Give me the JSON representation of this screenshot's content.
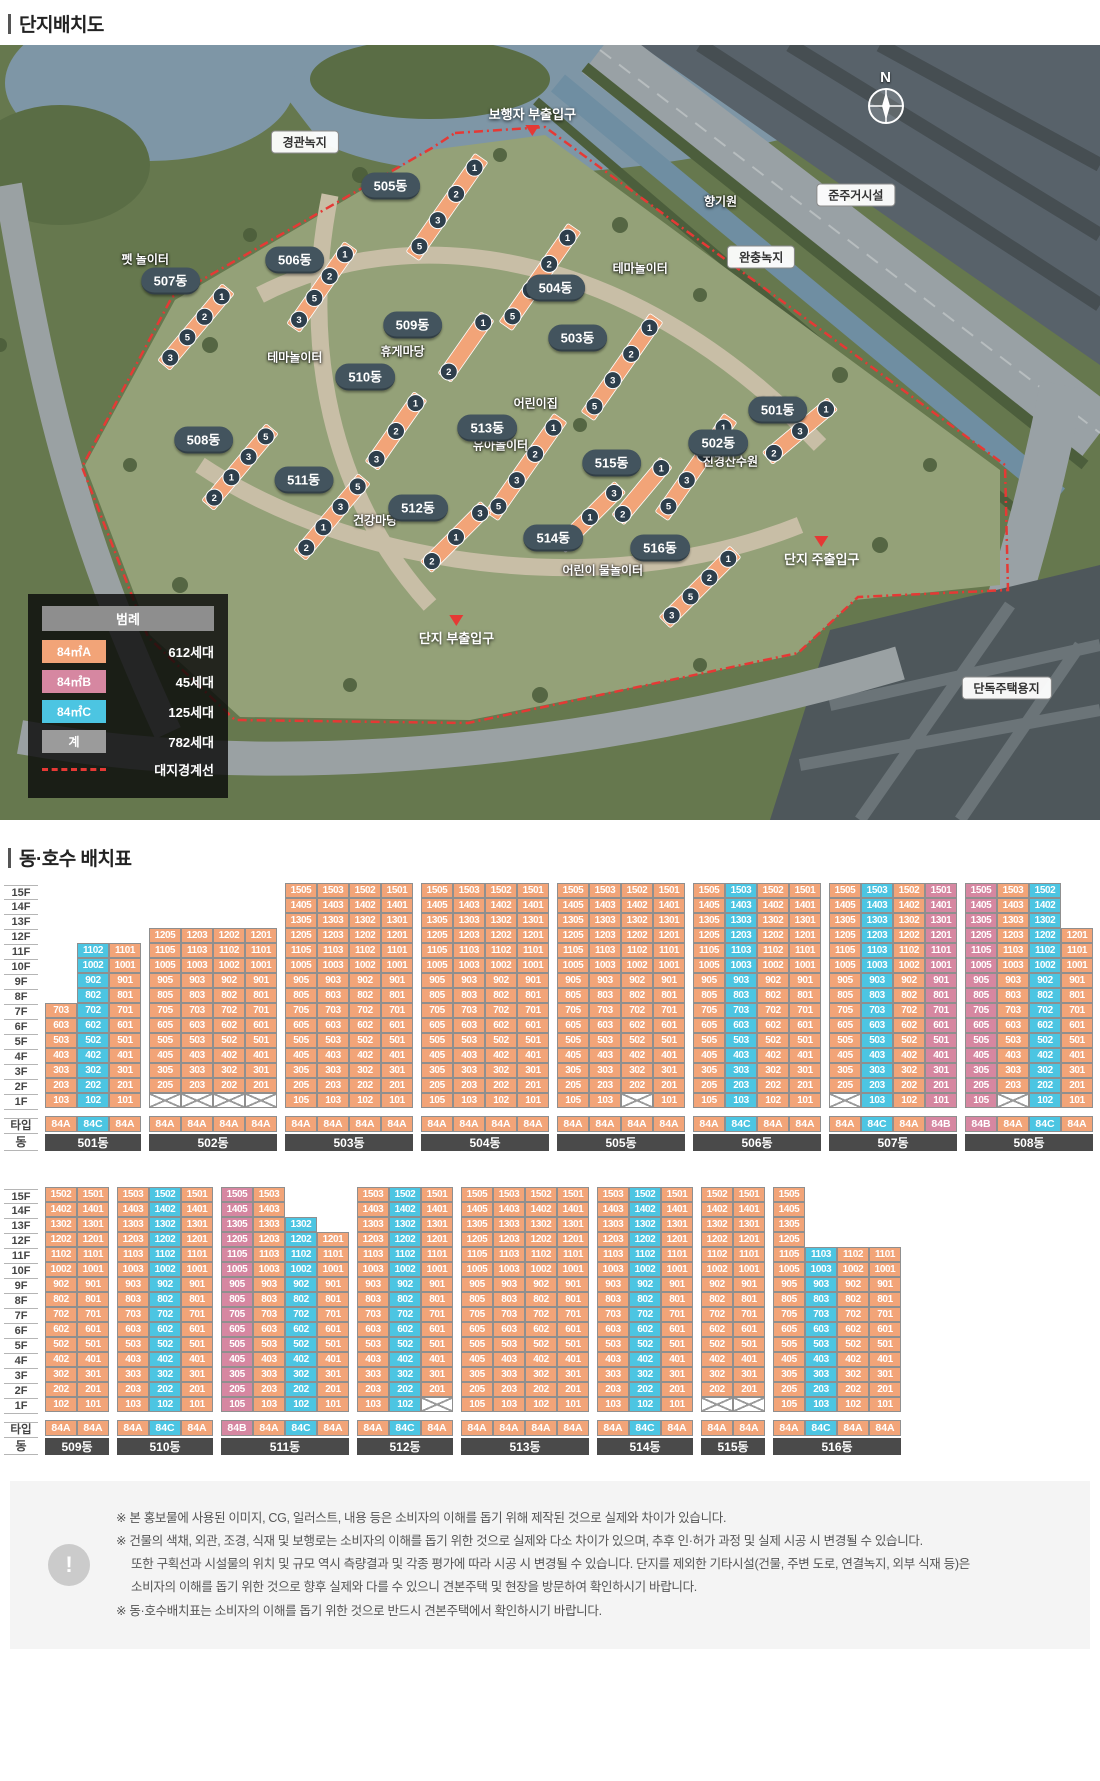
{
  "page": {
    "title_site": "단지배치도",
    "title_units": "동·호수 배치표"
  },
  "colors": {
    "A": "#F2A478",
    "B": "#D687A1",
    "C": "#4CC5E2",
    "gray": "#9B9B9B",
    "pill": "#43545E"
  },
  "map": {
    "compass": "N",
    "area_labels": [
      {
        "text": "경관녹지",
        "x": 27.7,
        "y": 12.5
      },
      {
        "text": "준주거시설",
        "x": 77.8,
        "y": 19.4
      },
      {
        "text": "완충녹지",
        "x": 69.2,
        "y": 27.3
      },
      {
        "text": "단독주택용지",
        "x": 91.5,
        "y": 83.0
      }
    ],
    "facility_labels": [
      {
        "text": "펫 놀이터",
        "x": 13.2,
        "y": 27.6
      },
      {
        "text": "향기원",
        "x": 65.5,
        "y": 20.1
      },
      {
        "text": "테마놀이터",
        "x": 58.2,
        "y": 28.8
      },
      {
        "text": "테마놀이터",
        "x": 26.8,
        "y": 40.3
      },
      {
        "text": "휴게마당",
        "x": 36.6,
        "y": 39.5
      },
      {
        "text": "어린이집",
        "x": 48.7,
        "y": 46.2
      },
      {
        "text": "건강마당",
        "x": 70.6,
        "y": 46.2
      },
      {
        "text": "진경산수원",
        "x": 66.4,
        "y": 53.7
      },
      {
        "text": "유아놀이터",
        "x": 45.5,
        "y": 51.6
      },
      {
        "text": "건강마당",
        "x": 34.1,
        "y": 61.3
      },
      {
        "text": "어린이 물놀이터",
        "x": 54.8,
        "y": 67.8
      }
    ],
    "entrances": [
      {
        "text": "보행자 부출입구",
        "x": 48.4,
        "y": 9.7,
        "dir": "down"
      },
      {
        "text": "단지 주출입구",
        "x": 74.7,
        "y": 65.4,
        "dir": "up"
      },
      {
        "text": "단지 부출입구",
        "x": 41.5,
        "y": 75.6,
        "dir": "up"
      }
    ],
    "buildings": [
      {
        "label": "505동",
        "x": 35.5,
        "y": 18.2,
        "bar": [
          447,
          162,
          -55,
          120
        ],
        "circles": [
          1,
          2,
          3,
          5
        ]
      },
      {
        "label": "506동",
        "x": 26.8,
        "y": 27.7,
        "bar": [
          322,
          242,
          -55,
          100
        ],
        "circles": [
          1,
          2,
          5,
          3
        ]
      },
      {
        "label": "507동",
        "x": 15.5,
        "y": 30.5,
        "bar": [
          196,
          282,
          -50,
          100
        ],
        "circles": [
          1,
          2,
          5,
          3
        ]
      },
      {
        "label": "504동",
        "x": 50.5,
        "y": 31.4,
        "bar": [
          540,
          232,
          -55,
          120
        ],
        "circles": [
          1,
          2,
          3,
          5
        ]
      },
      {
        "label": "509동",
        "x": 37.5,
        "y": 36.1,
        "bar": [
          466,
          302,
          -55,
          75
        ],
        "circles": [
          1,
          2
        ]
      },
      {
        "label": "503동",
        "x": 52.5,
        "y": 37.8,
        "bar": [
          622,
          322,
          -55,
          120
        ],
        "circles": [
          1,
          2,
          3,
          5
        ]
      },
      {
        "label": "510동",
        "x": 33.2,
        "y": 42.8,
        "bar": [
          396,
          386,
          -55,
          85
        ],
        "circles": [
          1,
          2,
          3
        ]
      },
      {
        "label": "501동",
        "x": 70.7,
        "y": 47.1,
        "bar": [
          800,
          386,
          -40,
          85
        ],
        "circles": [
          1,
          3,
          2
        ]
      },
      {
        "label": "513동",
        "x": 44.3,
        "y": 49.4,
        "bar": [
          526,
          422,
          -55,
          120
        ],
        "circles": [
          1,
          2,
          3,
          5
        ]
      },
      {
        "label": "502동",
        "x": 65.3,
        "y": 51.4,
        "bar": [
          696,
          422,
          -55,
          120
        ],
        "circles": [
          1,
          2,
          3,
          5
        ]
      },
      {
        "label": "508동",
        "x": 18.5,
        "y": 51.0,
        "bar": [
          240,
          422,
          -50,
          100
        ],
        "circles": [
          5,
          3,
          1,
          2
        ]
      },
      {
        "label": "515동",
        "x": 55.6,
        "y": 53.9,
        "bar": [
          642,
          446,
          -50,
          75
        ],
        "circles": [
          1,
          2
        ]
      },
      {
        "label": "511동",
        "x": 27.6,
        "y": 56.1,
        "bar": [
          332,
          472,
          -50,
          100
        ],
        "circles": [
          5,
          3,
          1,
          2
        ]
      },
      {
        "label": "512동",
        "x": 38.0,
        "y": 59.7,
        "bar": [
          456,
          492,
          -45,
          85
        ],
        "circles": [
          3,
          1,
          2
        ]
      },
      {
        "label": "514동",
        "x": 50.3,
        "y": 63.6,
        "bar": [
          590,
          472,
          -45,
          85
        ],
        "circles": [
          3,
          1,
          2
        ]
      },
      {
        "label": "516동",
        "x": 60.0,
        "y": 64.9,
        "bar": [
          700,
          542,
          -45,
          100
        ],
        "circles": [
          1,
          2,
          5,
          3
        ]
      }
    ]
  },
  "legend": {
    "title": "범례",
    "items": [
      {
        "label": "84㎡A",
        "type": "A",
        "count": "612세대"
      },
      {
        "label": "84㎡B",
        "type": "B",
        "count": "45세대"
      },
      {
        "label": "84㎡C",
        "type": "C",
        "count": "125세대"
      },
      {
        "label": "계",
        "type": "gray",
        "count": "782세대"
      }
    ],
    "boundary_label": "대지경계선"
  },
  "unit_table": {
    "floor_labels": [
      "15F",
      "14F",
      "13F",
      "12F",
      "11F",
      "10F",
      "9F",
      "8F",
      "7F",
      "6F",
      "5F",
      "4F",
      "3F",
      "2F",
      "1F"
    ],
    "type_row_label": "타입",
    "dong_row_label": "동",
    "rows": [
      [
        {
          "label": "501동",
          "cols": [
            {
              "s": "03",
              "t": "A",
              "top": 7,
              "f1": "103"
            },
            {
              "s": "02",
              "t": "C",
              "top": 11,
              "f1": "102"
            },
            {
              "s": "01",
              "t": "A",
              "top": 11,
              "f1": "101"
            }
          ]
        },
        {
          "label": "502동",
          "cols": [
            {
              "s": "05",
              "t": "A",
              "top": 12,
              "f1": "X"
            },
            {
              "s": "03",
              "t": "A",
              "top": 12,
              "f1": "X"
            },
            {
              "s": "02",
              "t": "A",
              "top": 12,
              "f1": "X"
            },
            {
              "s": "01",
              "t": "A",
              "top": 12,
              "f1": "X"
            }
          ]
        },
        {
          "label": "503동",
          "cols": [
            {
              "s": "05",
              "t": "A",
              "top": 15,
              "f1": "105"
            },
            {
              "s": "03",
              "t": "A",
              "top": 15,
              "f1": "103"
            },
            {
              "s": "02",
              "t": "A",
              "top": 15,
              "f1": "102"
            },
            {
              "s": "01",
              "t": "A",
              "top": 15,
              "f1": "101"
            }
          ]
        },
        {
          "label": "504동",
          "cols": [
            {
              "s": "05",
              "t": "A",
              "top": 15,
              "f1": "105"
            },
            {
              "s": "03",
              "t": "A",
              "top": 15,
              "f1": "103"
            },
            {
              "s": "02",
              "t": "A",
              "top": 15,
              "f1": "102"
            },
            {
              "s": "01",
              "t": "A",
              "top": 15,
              "f1": "101"
            }
          ]
        },
        {
          "label": "505동",
          "cols": [
            {
              "s": "05",
              "t": "A",
              "top": 15,
              "f1": "105"
            },
            {
              "s": "03",
              "t": "A",
              "top": 15,
              "f1": "103"
            },
            {
              "s": "02",
              "t": "A",
              "top": 15,
              "f1": "X"
            },
            {
              "s": "01",
              "t": "A",
              "top": 15,
              "f1": "101"
            }
          ]
        },
        {
          "label": "506동",
          "cols": [
            {
              "s": "05",
              "t": "A",
              "top": 15,
              "f1": "105"
            },
            {
              "s": "03",
              "t": "C",
              "top": 15,
              "f1": "103"
            },
            {
              "s": "02",
              "t": "A",
              "top": 15,
              "f1": "102"
            },
            {
              "s": "01",
              "t": "A",
              "top": 15,
              "f1": "101"
            }
          ]
        },
        {
          "label": "507동",
          "cols": [
            {
              "s": "05",
              "t": "A",
              "top": 15,
              "f1": "X"
            },
            {
              "s": "03",
              "t": "C",
              "top": 15,
              "f1": "103"
            },
            {
              "s": "02",
              "t": "A",
              "top": 15,
              "f1": "102"
            },
            {
              "s": "01",
              "t": "B",
              "top": 15,
              "f1": "101"
            }
          ]
        },
        {
          "label": "508동",
          "cols": [
            {
              "s": "05",
              "t": "B",
              "top": 15,
              "f1": "105"
            },
            {
              "s": "03",
              "t": "A",
              "top": 15,
              "f1": "X"
            },
            {
              "s": "02",
              "t": "C",
              "top": 15,
              "f1": "102"
            },
            {
              "s": "01",
              "t": "A",
              "top": 12,
              "f1": "101"
            }
          ]
        }
      ],
      [
        {
          "label": "509동",
          "cols": [
            {
              "s": "02",
              "t": "A",
              "top": 15,
              "f1": "102"
            },
            {
              "s": "01",
              "t": "A",
              "top": 15,
              "f1": "101"
            }
          ]
        },
        {
          "label": "510동",
          "cols": [
            {
              "s": "03",
              "t": "A",
              "top": 15,
              "f1": "103"
            },
            {
              "s": "02",
              "t": "C",
              "top": 15,
              "f1": "102"
            },
            {
              "s": "01",
              "t": "A",
              "top": 15,
              "f1": "101"
            }
          ]
        },
        {
          "label": "511동",
          "cols": [
            {
              "s": "05",
              "t": "B",
              "top": 15,
              "f1": "105"
            },
            {
              "s": "03",
              "t": "A",
              "top": 15,
              "f1": "103"
            },
            {
              "s": "02",
              "t": "C",
              "top": 13,
              "f1": "102"
            },
            {
              "s": "01",
              "t": "A",
              "top": 12,
              "f1": "101"
            }
          ]
        },
        {
          "label": "512동",
          "cols": [
            {
              "s": "03",
              "t": "A",
              "top": 15,
              "f1": "103"
            },
            {
              "s": "02",
              "t": "C",
              "top": 15,
              "f1": "102"
            },
            {
              "s": "01",
              "t": "A",
              "top": 15,
              "f1": "X"
            }
          ]
        },
        {
          "label": "513동",
          "cols": [
            {
              "s": "05",
              "t": "A",
              "top": 15,
              "f1": "105"
            },
            {
              "s": "03",
              "t": "A",
              "top": 15,
              "f1": "103"
            },
            {
              "s": "02",
              "t": "A",
              "top": 15,
              "f1": "102"
            },
            {
              "s": "01",
              "t": "A",
              "top": 15,
              "f1": "101"
            }
          ]
        },
        {
          "label": "514동",
          "cols": [
            {
              "s": "03",
              "t": "A",
              "top": 15,
              "f1": "103"
            },
            {
              "s": "02",
              "t": "C",
              "top": 15,
              "f1": "102"
            },
            {
              "s": "01",
              "t": "A",
              "top": 15,
              "f1": "101"
            }
          ]
        },
        {
          "label": "515동",
          "cols": [
            {
              "s": "02",
              "t": "A",
              "top": 15,
              "f1": "X"
            },
            {
              "s": "01",
              "t": "A",
              "top": 15,
              "f1": "X"
            }
          ]
        },
        {
          "label": "516동",
          "cols": [
            {
              "s": "05",
              "t": "A",
              "top": 15,
              "f1": "105"
            },
            {
              "s": "03",
              "t": "C",
              "top": 11,
              "f1": "103"
            },
            {
              "s": "02",
              "t": "A",
              "top": 11,
              "f1": "102"
            },
            {
              "s": "01",
              "t": "A",
              "top": 11,
              "f1": "101"
            }
          ]
        }
      ]
    ]
  },
  "footer": {
    "mark": "!",
    "lines": [
      {
        "text": "※ 본 홍보물에 사용된 이미지, CG, 일러스트, 내용 등은 소비자의 이해를 돕기 위해 제작된 것으로 실제와 차이가 있습니다.",
        "indent": false
      },
      {
        "text": "※ 건물의 색채, 외관, 조경, 식재 및 보행로는 소비자의 이해를 돕기 위한 것으로 실제와 다소 차이가 있으며, 추후 인·허가 과정 및 실제 시공 시 변경될 수 있습니다.",
        "indent": false
      },
      {
        "text": "또한 구획선과 시설물의 위치 및 규모 역시 측량결과 및 각종 평가에 따라 시공 시 변경될 수 있습니다. 단지를 제외한 기타시설(건물, 주변 도로, 연결녹지, 외부 식재 등)은",
        "indent": true
      },
      {
        "text": "소비자의 이해를 돕기 위한 것으로 향후 실제와 다를 수 있으니 견본주택 및 현장을 방문하여 확인하시기 바랍니다.",
        "indent": true
      },
      {
        "text": "※ 동·호수배치표는 소비자의 이해를 돕기 위한 것으로 반드시 견본주택에서 확인하시기 바랍니다.",
        "indent": false
      }
    ]
  }
}
